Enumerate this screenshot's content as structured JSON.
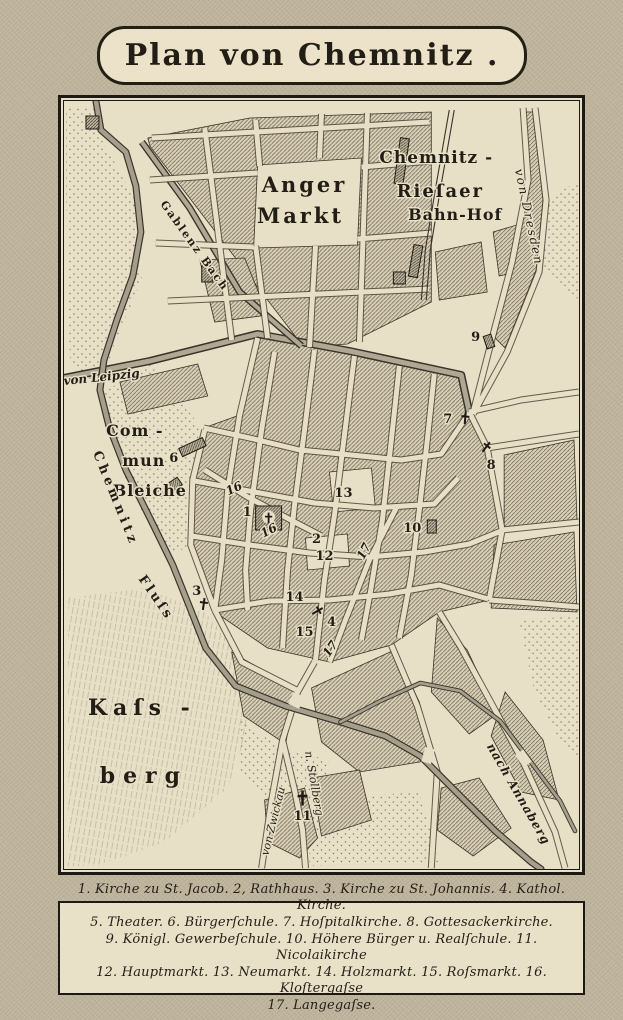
{
  "title": "Plan von Chemnitz .",
  "colors": {
    "paper": "#c2b8a1",
    "map_background": "#e8dfc7",
    "ink": "#221d15",
    "block_hatch": "#6b6350",
    "water": "#a49e8a"
  },
  "map": {
    "labels": {
      "anger1": "Anger",
      "anger2": "Markt",
      "bahnhof1": "Chemnitz -",
      "bahnhof2": "Rieſaer",
      "bahnhof3": "Bahn-Hof",
      "von_dresden": "von Dresden",
      "von_leipzig": "von Leipzig",
      "gablenz_bach": "Gablenz Bach",
      "commun1": "Com -",
      "commun2": "mun",
      "commun3": "Bleiche",
      "fluss1": "Chemnitz",
      "fluss2": "Fluſs",
      "kassberg1": "Kaſs -",
      "kassberg2": "berg",
      "nach_annaberg": "nach Annaberg",
      "von_zwickau": "von Zwickau",
      "stollberg": "n. Stollberg"
    },
    "markers": {
      "m1": "1",
      "m2": "2",
      "m3": "3",
      "m4": "4",
      "m5": "5",
      "m6": "6",
      "m7": "7",
      "m8": "8",
      "m9": "9",
      "m10": "10",
      "m11": "11",
      "m12": "12",
      "m13": "13",
      "m14": "14",
      "m15": "15",
      "s16": "16",
      "s17": "17"
    }
  },
  "legend": {
    "lines": [
      "1. Kirche zu St. Jacob. 2, Rathhaus. 3. Kirche zu St. Johannis. 4. Kathol. Kirche.",
      "5. Theater. 6. Bürgerſchule. 7. Hoſpitalkirche. 8. Gottesackerkirche.",
      "9. Königl. Gewerbeſchule. 10. Höhere Bürger u. Realſchule. 11. Nicolaikirche",
      "12. Hauptmarkt. 13. Neumarkt. 14. Holzmarkt. 15. Roſsmarkt. 16. Kloſtergaſse",
      "17. Langegaſse."
    ]
  }
}
